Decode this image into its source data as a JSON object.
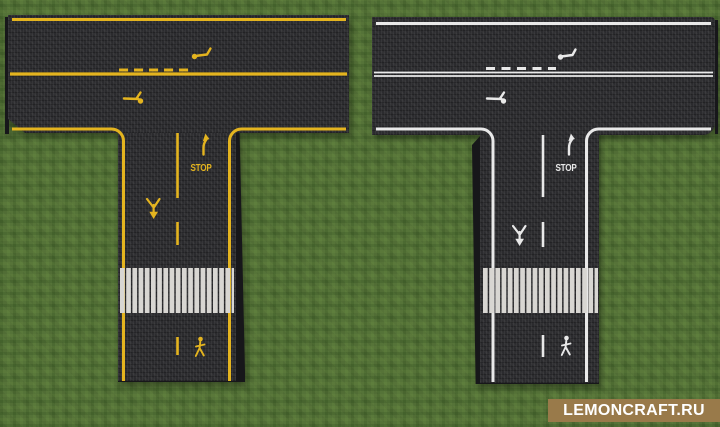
{
  "scene": {
    "description": "Minecraft screenshot: two T-junction asphalt road blocks on grass",
    "grass_color": "#557338",
    "asphalt_color": "#2b2b2e",
    "crosswalk_color": "#d8d6d2"
  },
  "roads": [
    {
      "id": "left-yellow",
      "marking_color": "#e4b41f",
      "stop_label": "STOP",
      "markings": [
        "edge-lines",
        "center-line-with-dashes",
        "lane-arrows",
        "right-turn-arrow",
        "stop-text",
        "merge-arrow",
        "crosswalk",
        "pedestrian-symbol"
      ]
    },
    {
      "id": "right-white",
      "marking_color": "#e9e9e9",
      "stop_label": "STOP",
      "markings": [
        "edge-lines",
        "double-center-line-with-dashes",
        "lane-arrows",
        "right-turn-arrow",
        "stop-text",
        "merge-arrow",
        "crosswalk",
        "pedestrian-symbol"
      ]
    }
  ],
  "watermark": {
    "text": "LEMONCRAFT.RU",
    "background": "#997a4a",
    "color": "#ffffff"
  }
}
